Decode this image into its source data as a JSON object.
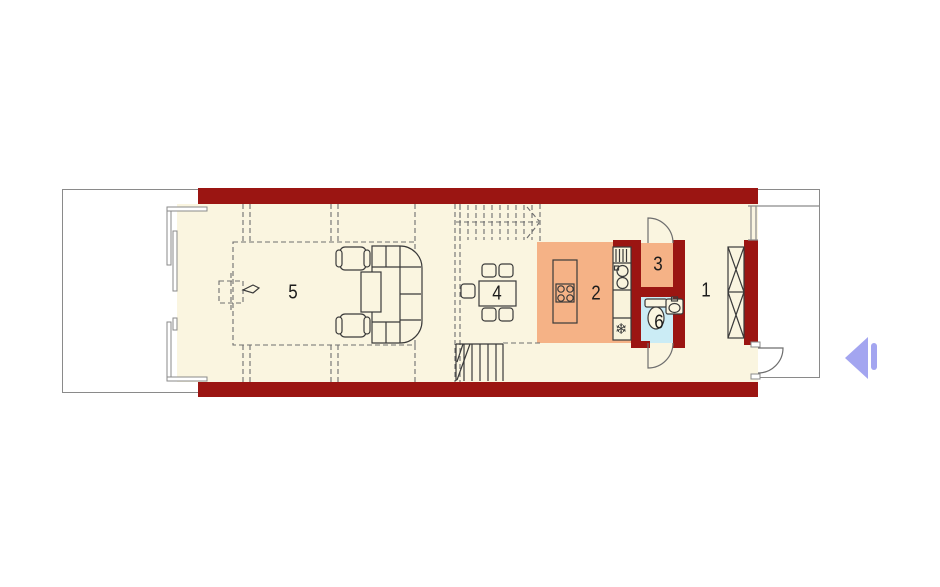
{
  "colors": {
    "wall": "#9b1512",
    "floor": "#faf5e0",
    "kitchen": "#f5b286",
    "bath": "#cbecf5",
    "terrace": "#ffffff",
    "outline": "#8a8a8a",
    "arrow": "#a3a5f0",
    "label": "#1c1c1c"
  },
  "plan": {
    "rooms": [
      {
        "label": "1"
      },
      {
        "label": "2"
      },
      {
        "label": "3"
      },
      {
        "label": "4"
      },
      {
        "label": "5"
      },
      {
        "label": "6"
      }
    ]
  },
  "icons": {
    "freezer_glyph": "❄",
    "nav_prev": "left-triangle"
  }
}
